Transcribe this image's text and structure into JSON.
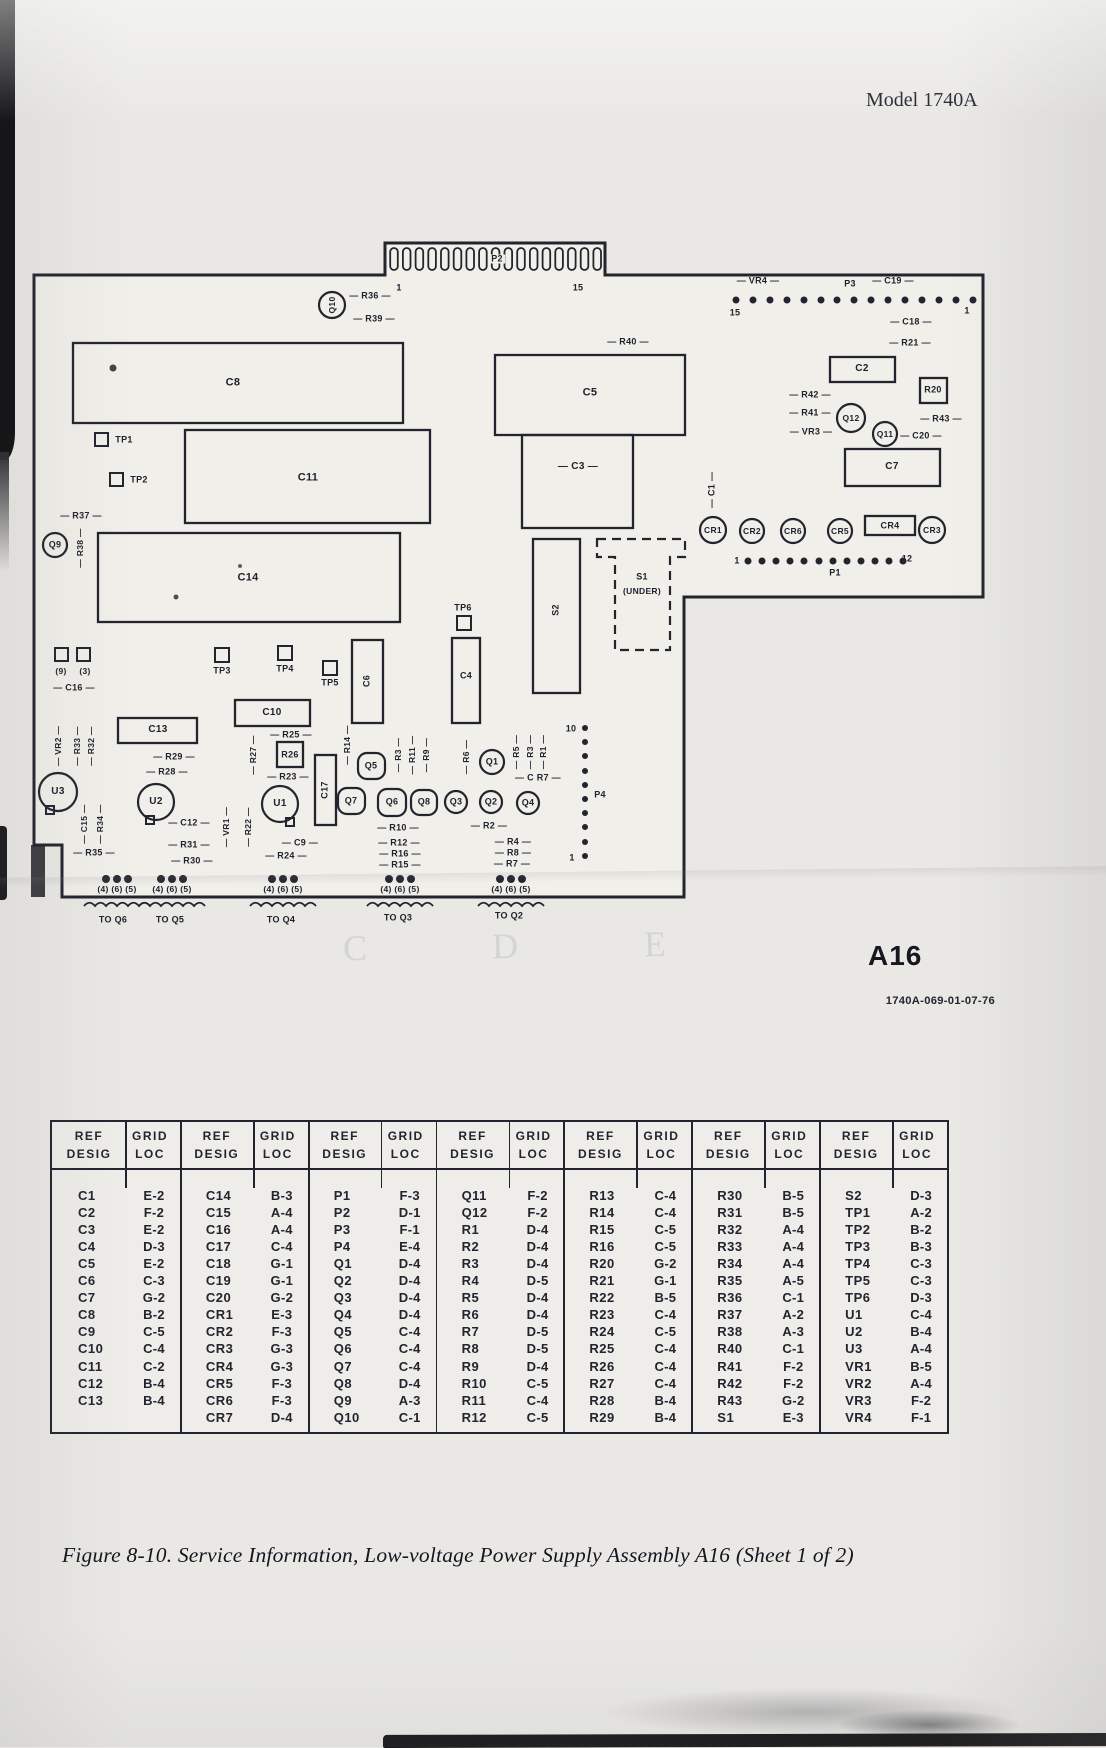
{
  "meta": {
    "model": "Model 1740A",
    "board_id": "A16",
    "doc_number": "1740A-069-01-07-76",
    "caption": "Figure 8-10. Service Information, Low-voltage Power  Supply Assembly A16 (Sheet 1 of 2)"
  },
  "ghost_letters": [
    "C",
    "D",
    "E"
  ],
  "diagram": {
    "labels": [
      {
        "t": "P2",
        "x": 497,
        "y": 259,
        "fs": 9,
        "bg": 1
      },
      {
        "t": "1",
        "x": 399,
        "y": 288,
        "fs": 9
      },
      {
        "t": "15",
        "x": 578,
        "y": 288,
        "fs": 9
      },
      {
        "t": "— R36 —",
        "x": 370,
        "y": 296,
        "fs": 9
      },
      {
        "t": "— R39 —",
        "x": 374,
        "y": 319,
        "fs": 9
      },
      {
        "t": "Q10",
        "x": 332,
        "y": 305,
        "fs": 8.5,
        "r": 1
      },
      {
        "t": "— VR4 —",
        "x": 758,
        "y": 281,
        "fs": 9
      },
      {
        "t": "P3",
        "x": 850,
        "y": 284,
        "fs": 9
      },
      {
        "t": "— C19 —",
        "x": 893,
        "y": 281,
        "fs": 9
      },
      {
        "t": "15",
        "x": 735,
        "y": 313,
        "fs": 9
      },
      {
        "t": "1",
        "x": 967,
        "y": 311,
        "fs": 9
      },
      {
        "t": "— C18 —",
        "x": 911,
        "y": 322,
        "fs": 9
      },
      {
        "t": "— R21 —",
        "x": 910,
        "y": 343,
        "fs": 9
      },
      {
        "t": "C2",
        "x": 862,
        "y": 369,
        "fs": 10
      },
      {
        "t": "R20",
        "x": 933,
        "y": 390,
        "fs": 9
      },
      {
        "t": "— R42 —",
        "x": 810,
        "y": 395,
        "fs": 9
      },
      {
        "t": "— R41 —",
        "x": 810,
        "y": 413,
        "fs": 9
      },
      {
        "t": "— VR3 —",
        "x": 811,
        "y": 432,
        "fs": 9
      },
      {
        "t": "Q12",
        "x": 851,
        "y": 418,
        "fs": 8.5
      },
      {
        "t": "Q11",
        "x": 885,
        "y": 434,
        "fs": 8.5
      },
      {
        "t": "— R43 —",
        "x": 941,
        "y": 419,
        "fs": 9
      },
      {
        "t": "— C20 —",
        "x": 921,
        "y": 436,
        "fs": 9
      },
      {
        "t": "C7",
        "x": 892,
        "y": 467,
        "fs": 10
      },
      {
        "t": "— C1 —",
        "x": 712,
        "y": 490,
        "fs": 9,
        "r": 1
      },
      {
        "t": "CR1",
        "x": 713,
        "y": 530,
        "fs": 8.5
      },
      {
        "t": "CR2",
        "x": 752,
        "y": 531,
        "fs": 8.5
      },
      {
        "t": "CR6",
        "x": 793,
        "y": 531,
        "fs": 8.5
      },
      {
        "t": "CR5",
        "x": 840,
        "y": 531,
        "fs": 8.5
      },
      {
        "t": "CR4",
        "x": 890,
        "y": 526,
        "fs": 9
      },
      {
        "t": "CR3",
        "x": 932,
        "y": 530,
        "fs": 8.5
      },
      {
        "t": "1",
        "x": 737,
        "y": 561,
        "fs": 9
      },
      {
        "t": "P1",
        "x": 835,
        "y": 573,
        "fs": 9
      },
      {
        "t": "12",
        "x": 907,
        "y": 559,
        "fs": 9
      },
      {
        "t": "C8",
        "x": 233,
        "y": 383,
        "fs": 11
      },
      {
        "t": "TP1",
        "x": 124,
        "y": 440,
        "fs": 9
      },
      {
        "t": "TP2",
        "x": 139,
        "y": 480,
        "fs": 9
      },
      {
        "t": "C11",
        "x": 308,
        "y": 478,
        "fs": 11
      },
      {
        "t": "— R37 —",
        "x": 81,
        "y": 516,
        "fs": 9
      },
      {
        "t": "Q9",
        "x": 55,
        "y": 545,
        "fs": 9
      },
      {
        "t": "— R38 —",
        "x": 80,
        "y": 548,
        "fs": 8.5,
        "r": 1
      },
      {
        "t": "C14",
        "x": 248,
        "y": 578,
        "fs": 11
      },
      {
        "t": "— R40 —",
        "x": 628,
        "y": 342,
        "fs": 9
      },
      {
        "t": "C5",
        "x": 590,
        "y": 393,
        "fs": 11
      },
      {
        "t": "— C3 —",
        "x": 578,
        "y": 467,
        "fs": 10
      },
      {
        "t": "S1",
        "x": 642,
        "y": 577,
        "fs": 9
      },
      {
        "t": "(UNDER)",
        "x": 642,
        "y": 591,
        "fs": 8.5
      },
      {
        "t": "S2",
        "x": 556,
        "y": 610,
        "fs": 9,
        "r": 1
      },
      {
        "t": "TP6",
        "x": 463,
        "y": 608,
        "fs": 9
      },
      {
        "t": "C4",
        "x": 466,
        "y": 676,
        "fs": 9
      },
      {
        "t": "(9)",
        "x": 61,
        "y": 671,
        "fs": 8.5
      },
      {
        "t": "(3)",
        "x": 85,
        "y": 671,
        "fs": 8.5
      },
      {
        "t": "— C16 —",
        "x": 74,
        "y": 688,
        "fs": 9
      },
      {
        "t": "TP3",
        "x": 222,
        "y": 671,
        "fs": 9
      },
      {
        "t": "TP4",
        "x": 285,
        "y": 669,
        "fs": 9
      },
      {
        "t": "TP5",
        "x": 330,
        "y": 683,
        "fs": 9
      },
      {
        "t": "C6",
        "x": 367,
        "y": 681,
        "fs": 9,
        "r": 1
      },
      {
        "t": "C10",
        "x": 272,
        "y": 713,
        "fs": 10
      },
      {
        "t": "— R25 —",
        "x": 291,
        "y": 735,
        "fs": 9
      },
      {
        "t": "R26",
        "x": 290,
        "y": 755,
        "fs": 9
      },
      {
        "t": "— R27 —",
        "x": 253,
        "y": 755,
        "fs": 8.5,
        "r": 1
      },
      {
        "t": "— R23 —",
        "x": 288,
        "y": 777,
        "fs": 9
      },
      {
        "t": "C13",
        "x": 158,
        "y": 730,
        "fs": 10
      },
      {
        "t": "— R29 —",
        "x": 174,
        "y": 757,
        "fs": 9
      },
      {
        "t": "— R28 —",
        "x": 167,
        "y": 772,
        "fs": 9
      },
      {
        "t": "— VR2 —",
        "x": 58,
        "y": 746,
        "fs": 8.5,
        "r": 1
      },
      {
        "t": "— R33 —",
        "x": 77,
        "y": 746,
        "fs": 8.5,
        "r": 1
      },
      {
        "t": "— R32 —",
        "x": 91,
        "y": 746,
        "fs": 8.5,
        "r": 1
      },
      {
        "t": "U3",
        "x": 58,
        "y": 792,
        "fs": 10
      },
      {
        "t": "— C15 —",
        "x": 84,
        "y": 824,
        "fs": 8.5,
        "r": 1
      },
      {
        "t": "— R34 —",
        "x": 100,
        "y": 824,
        "fs": 8.5,
        "r": 1
      },
      {
        "t": "— R35 —",
        "x": 94,
        "y": 853,
        "fs": 9
      },
      {
        "t": "U2",
        "x": 156,
        "y": 802,
        "fs": 10
      },
      {
        "t": "— C12 —",
        "x": 189,
        "y": 823,
        "fs": 9
      },
      {
        "t": "— VR1 —",
        "x": 226,
        "y": 827,
        "fs": 8.5,
        "r": 1
      },
      {
        "t": "— R22 —",
        "x": 248,
        "y": 827,
        "fs": 8.5,
        "r": 1
      },
      {
        "t": "U1",
        "x": 280,
        "y": 804,
        "fs": 10
      },
      {
        "t": "— C9 —",
        "x": 300,
        "y": 843,
        "fs": 9
      },
      {
        "t": "— R24 —",
        "x": 286,
        "y": 856,
        "fs": 9
      },
      {
        "t": "— R31 —",
        "x": 189,
        "y": 845,
        "fs": 9
      },
      {
        "t": "— R30 —",
        "x": 192,
        "y": 861,
        "fs": 9
      },
      {
        "t": "C17",
        "x": 325,
        "y": 790,
        "fs": 9,
        "r": 1
      },
      {
        "t": "— R14 —",
        "x": 347,
        "y": 745,
        "fs": 8.5,
        "r": 1
      },
      {
        "t": "Q5",
        "x": 371,
        "y": 766,
        "fs": 9
      },
      {
        "t": "— R3 —",
        "x": 398,
        "y": 755,
        "fs": 8.5,
        "r": 1
      },
      {
        "t": "— R11 —",
        "x": 412,
        "y": 755,
        "fs": 8.5,
        "r": 1
      },
      {
        "t": "— R9 —",
        "x": 426,
        "y": 755,
        "fs": 8.5,
        "r": 1
      },
      {
        "t": "Q7",
        "x": 351,
        "y": 801,
        "fs": 9
      },
      {
        "t": "Q6",
        "x": 392,
        "y": 802,
        "fs": 9
      },
      {
        "t": "Q8",
        "x": 424,
        "y": 802,
        "fs": 9
      },
      {
        "t": "— R6 —",
        "x": 466,
        "y": 757,
        "fs": 8.5,
        "r": 1
      },
      {
        "t": "Q1",
        "x": 492,
        "y": 762,
        "fs": 9
      },
      {
        "t": "— R5 —",
        "x": 516,
        "y": 752,
        "fs": 8.5,
        "r": 1
      },
      {
        "t": "— R3 —",
        "x": 530,
        "y": 752,
        "fs": 8.5,
        "r": 1
      },
      {
        "t": "— R1 —",
        "x": 543,
        "y": 752,
        "fs": 8.5,
        "r": 1
      },
      {
        "t": "— C R7 —",
        "x": 538,
        "y": 778,
        "fs": 9
      },
      {
        "t": "Q3",
        "x": 456,
        "y": 802,
        "fs": 9
      },
      {
        "t": "Q2",
        "x": 491,
        "y": 802,
        "fs": 9
      },
      {
        "t": "Q4",
        "x": 528,
        "y": 803,
        "fs": 9
      },
      {
        "t": "— R10 —",
        "x": 398,
        "y": 828,
        "fs": 9
      },
      {
        "t": "— R2 —",
        "x": 489,
        "y": 826,
        "fs": 9
      },
      {
        "t": "— R12 —",
        "x": 399,
        "y": 843,
        "fs": 9
      },
      {
        "t": "— R16 —",
        "x": 400,
        "y": 854,
        "fs": 9
      },
      {
        "t": "— R15 —",
        "x": 400,
        "y": 865,
        "fs": 9
      },
      {
        "t": "— R4 —",
        "x": 513,
        "y": 842,
        "fs": 9
      },
      {
        "t": "— R8 —",
        "x": 513,
        "y": 853,
        "fs": 9
      },
      {
        "t": "— R7 —",
        "x": 512,
        "y": 864,
        "fs": 9
      },
      {
        "t": "10",
        "x": 571,
        "y": 729,
        "fs": 9
      },
      {
        "t": "P4",
        "x": 600,
        "y": 795,
        "fs": 9
      },
      {
        "t": "1",
        "x": 572,
        "y": 858,
        "fs": 9
      },
      {
        "t": "(4) (6) (5)",
        "x": 117,
        "y": 889,
        "fs": 8.5
      },
      {
        "t": "(4) (6) (5)",
        "x": 172,
        "y": 889,
        "fs": 8.5
      },
      {
        "t": "(4) (6) (5)",
        "x": 283,
        "y": 889,
        "fs": 8.5
      },
      {
        "t": "(4) (6) (5)",
        "x": 400,
        "y": 889,
        "fs": 8.5
      },
      {
        "t": "(4) (6) (5)",
        "x": 511,
        "y": 889,
        "fs": 8.5
      },
      {
        "t": "TO Q6",
        "x": 113,
        "y": 920,
        "fs": 9
      },
      {
        "t": "TO Q5",
        "x": 170,
        "y": 920,
        "fs": 9
      },
      {
        "t": "TO Q4",
        "x": 281,
        "y": 920,
        "fs": 9
      },
      {
        "t": "TO Q3",
        "x": 398,
        "y": 918,
        "fs": 9
      },
      {
        "t": "TO Q2",
        "x": 509,
        "y": 916,
        "fs": 9
      }
    ]
  },
  "table": {
    "header": {
      "ref1": "REF",
      "ref2": "DESIG",
      "grid1": "GRID",
      "grid2": "LOC"
    },
    "pairs": [
      {
        "rows": [
          [
            "C1",
            "E-2"
          ],
          [
            "C2",
            "F-2"
          ],
          [
            "C3",
            "E-2"
          ],
          [
            "C4",
            "D-3"
          ],
          [
            "C5",
            "E-2"
          ],
          [
            "C6",
            "C-3"
          ],
          [
            "C7",
            "G-2"
          ],
          [
            "C8",
            "B-2"
          ],
          [
            "C9",
            "C-5"
          ],
          [
            "C10",
            "C-4"
          ],
          [
            "C11",
            "C-2"
          ],
          [
            "C12",
            "B-4"
          ],
          [
            "C13",
            "B-4"
          ]
        ]
      },
      {
        "rows": [
          [
            "C14",
            "B-3"
          ],
          [
            "C15",
            "A-4"
          ],
          [
            "C16",
            "A-4"
          ],
          [
            "C17",
            "C-4"
          ],
          [
            "C18",
            "G-1"
          ],
          [
            "C19",
            "G-1"
          ],
          [
            "C20",
            "G-2"
          ],
          [
            "CR1",
            "E-3"
          ],
          [
            "CR2",
            "F-3"
          ],
          [
            "CR3",
            "G-3"
          ],
          [
            "CR4",
            "G-3"
          ],
          [
            "CR5",
            "F-3"
          ],
          [
            "CR6",
            "F-3"
          ],
          [
            "CR7",
            "D-4"
          ]
        ]
      },
      {
        "rows": [
          [
            "P1",
            "F-3"
          ],
          [
            "P2",
            "D-1"
          ],
          [
            "P3",
            "F-1"
          ],
          [
            "P4",
            "E-4"
          ],
          [
            "Q1",
            "D-4"
          ],
          [
            "Q2",
            "D-4"
          ],
          [
            "Q3",
            "D-4"
          ],
          [
            "Q4",
            "D-4"
          ],
          [
            "Q5",
            "C-4"
          ],
          [
            "Q6",
            "C-4"
          ],
          [
            "Q7",
            "C-4"
          ],
          [
            "Q8",
            "D-4"
          ],
          [
            "Q9",
            "A-3"
          ],
          [
            "Q10",
            "C-1"
          ]
        ]
      },
      {
        "rows": [
          [
            "Q11",
            "F-2"
          ],
          [
            "Q12",
            "F-2"
          ],
          [
            "R1",
            "D-4"
          ],
          [
            "R2",
            "D-4"
          ],
          [
            "R3",
            "D-4"
          ],
          [
            "R4",
            "D-5"
          ],
          [
            "R5",
            "D-4"
          ],
          [
            "R6",
            "D-4"
          ],
          [
            "R7",
            "D-5"
          ],
          [
            "R8",
            "D-5"
          ],
          [
            "R9",
            "D-4"
          ],
          [
            "R10",
            "C-5"
          ],
          [
            "R11",
            "C-4"
          ],
          [
            "R12",
            "C-5"
          ]
        ]
      },
      {
        "rows": [
          [
            "R13",
            "C-4"
          ],
          [
            "R14",
            "C-4"
          ],
          [
            "R15",
            "C-5"
          ],
          [
            "R16",
            "C-5"
          ],
          [
            "R20",
            "G-2"
          ],
          [
            "R21",
            "G-1"
          ],
          [
            "R22",
            "B-5"
          ],
          [
            "R23",
            "C-4"
          ],
          [
            "R24",
            "C-5"
          ],
          [
            "R25",
            "C-4"
          ],
          [
            "R26",
            "C-4"
          ],
          [
            "R27",
            "C-4"
          ],
          [
            "R28",
            "B-4"
          ],
          [
            "R29",
            "B-4"
          ]
        ]
      },
      {
        "rows": [
          [
            "R30",
            "B-5"
          ],
          [
            "R31",
            "B-5"
          ],
          [
            "R32",
            "A-4"
          ],
          [
            "R33",
            "A-4"
          ],
          [
            "R34",
            "A-4"
          ],
          [
            "R35",
            "A-5"
          ],
          [
            "R36",
            "C-1"
          ],
          [
            "R37",
            "A-2"
          ],
          [
            "R38",
            "A-3"
          ],
          [
            "R40",
            "C-1"
          ],
          [
            "R41",
            "F-2"
          ],
          [
            "R42",
            "F-2"
          ],
          [
            "R43",
            "G-2"
          ],
          [
            "S1",
            "E-3"
          ]
        ]
      },
      {
        "rows": [
          [
            "S2",
            "D-3"
          ],
          [
            "TP1",
            "A-2"
          ],
          [
            "TP2",
            "B-2"
          ],
          [
            "TP3",
            "B-3"
          ],
          [
            "TP4",
            "C-3"
          ],
          [
            "TP5",
            "C-3"
          ],
          [
            "TP6",
            "D-3"
          ],
          [
            "U1",
            "C-4"
          ],
          [
            "U2",
            "B-4"
          ],
          [
            "U3",
            "A-4"
          ],
          [
            "VR1",
            "B-5"
          ],
          [
            "VR2",
            "A-4"
          ],
          [
            "VR3",
            "F-2"
          ],
          [
            "VR4",
            "F-1"
          ]
        ]
      }
    ]
  }
}
